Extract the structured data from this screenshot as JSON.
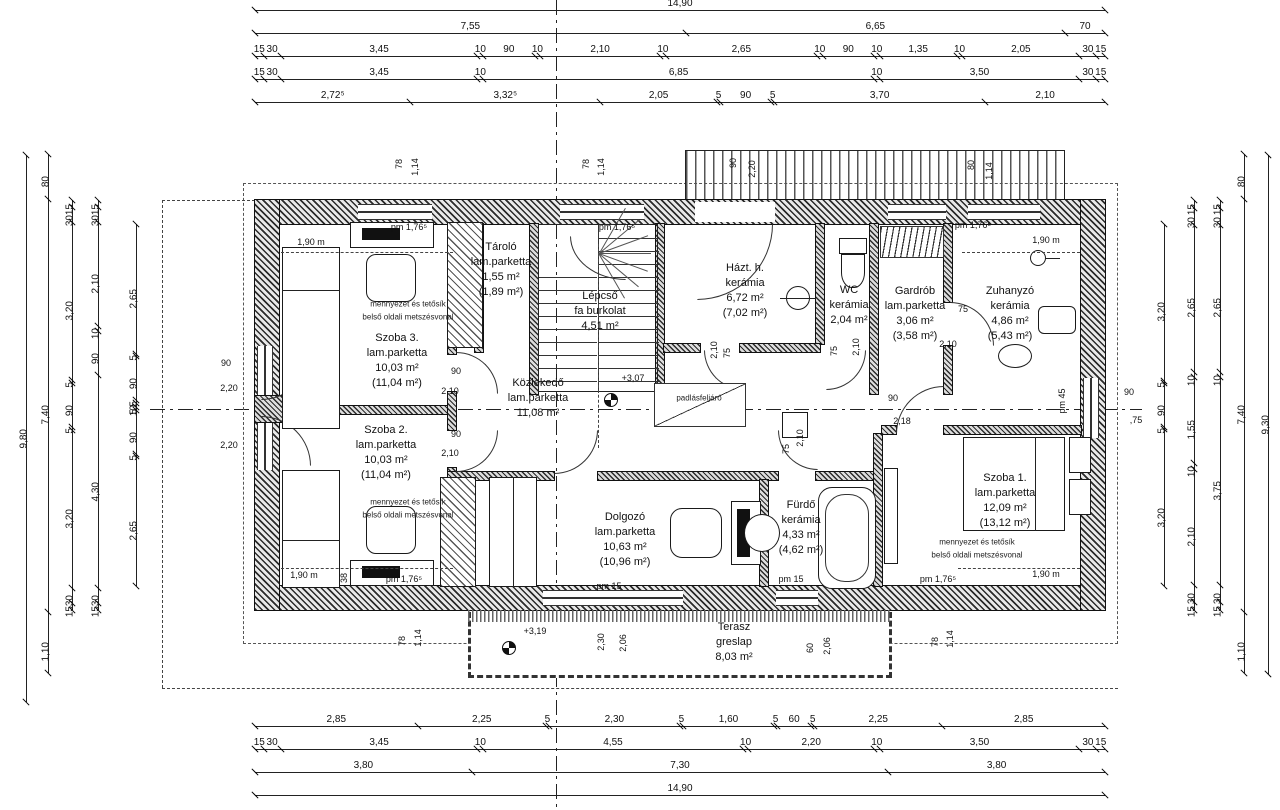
{
  "rooms": [
    {
      "name": "Szoba 3.",
      "material": "lam.parketta",
      "area": "10,03 m²",
      "area_total": "(11,04 m²)"
    },
    {
      "name": "Tároló",
      "material": "lam.parketta",
      "area": "1,55 m²",
      "area_total": "(1,89 m²)"
    },
    {
      "name": "Lépcső",
      "material": "fa burkolat",
      "area": "4,51 m²",
      "area_total": ""
    },
    {
      "name": "Házt. h.",
      "material": "kerámia",
      "area": "6,72 m²",
      "area_total": "(7,02 m²)"
    },
    {
      "name": "WC",
      "material": "kerámia",
      "area": "2,04 m²",
      "area_total": ""
    },
    {
      "name": "Gardrób",
      "material": "lam.parketta",
      "area": "3,06 m²",
      "area_total": "(3,58 m²)"
    },
    {
      "name": "Zuhanyzó",
      "material": "kerámia",
      "area": "4,86 m²",
      "area_total": "(5,43 m²)"
    },
    {
      "name": "Szoba 2.",
      "material": "lam.parketta",
      "area": "10,03 m²",
      "area_total": "(11,04 m²)"
    },
    {
      "name": "Közlekedő",
      "material": "lam.parketta",
      "area": "11,08 m²",
      "area_total": ""
    },
    {
      "name": "Dolgozó",
      "material": "lam.parketta",
      "area": "10,63 m²",
      "area_total": "(10,96 m²)"
    },
    {
      "name": "Fürdő",
      "material": "kerámia",
      "area": "4,33 m²",
      "area_total": "(4,62 m²)"
    },
    {
      "name": "Szoba 1.",
      "material": "lam.parketta",
      "area": "12,09 m²",
      "area_total": "(13,12 m²)"
    },
    {
      "name": "Terasz",
      "material": "greslap",
      "area": "8,03 m²",
      "area_total": ""
    }
  ],
  "levels": {
    "upper_floor": "+3,07",
    "terrace": "+3,19"
  },
  "notes": {
    "section_line_1": "mennyezet és tetősík",
    "section_line_2": "belső oldali metszésvonal",
    "attic_access": "padlásfeljáró"
  },
  "pm": {
    "pm176": "pm 1,76⁵",
    "pm15": "pm 15",
    "pm45": "pm 45"
  },
  "openings": {
    "w90": "90",
    "h210": "2,10",
    "w75": "75",
    "h218": "2,18",
    "h220": "2,20",
    "w230": "2,30",
    "w206": "2,06",
    "w60": "60",
    "w78": "78",
    "w114": "1,14",
    "w80": "80",
    "p75": ",75",
    "w38": "38",
    "bed": "1,90 m"
  },
  "dims": {
    "top": {
      "row1": [
        "14,90"
      ],
      "row2": [
        "7,55",
        "6,65",
        "70"
      ],
      "row3": [
        "15",
        "30",
        "3,45",
        "10",
        "90",
        "10",
        "2,10",
        "10",
        "2,65",
        "10",
        "90",
        "10",
        "1,35",
        "10",
        "2,05",
        "30",
        "15"
      ],
      "row4": [
        "15",
        "30",
        "3,45",
        "10",
        "6,85",
        "10",
        "3,50",
        "30",
        "15"
      ],
      "row5": [
        "2,72⁵",
        "3,32⁵",
        "2,05",
        "5",
        "90",
        "5",
        "3,70",
        "2,10"
      ]
    },
    "bottom": {
      "row1": [
        "2,85",
        "2,25",
        "5",
        "2,30",
        "5",
        "1,60",
        "5",
        "60",
        "5",
        "2,25",
        "2,85"
      ],
      "row2": [
        "15",
        "30",
        "3,45",
        "10",
        "4,55",
        "10",
        "2,20",
        "10",
        "3,50",
        "30",
        "15"
      ],
      "row3": [
        "3,80",
        "7,30",
        "3,80"
      ],
      "row4": [
        "14,90"
      ]
    },
    "left": {
      "c1": [
        "9,80"
      ],
      "c2": [
        "80",
        "7,40",
        "1,10"
      ],
      "c3": [
        "15",
        "30",
        "3,20",
        "5",
        "90",
        "5",
        "3,20",
        "30",
        "15"
      ],
      "c4": [
        "15",
        "30",
        "2,10",
        "10",
        "90",
        "4,30",
        "30",
        "15"
      ],
      "c5": [
        "2,65",
        "5",
        "90",
        "5",
        "10",
        "5",
        "90",
        "5",
        "2,65"
      ]
    },
    "right": {
      "c1": [
        "9,30"
      ],
      "c2": [
        "80",
        "7,40",
        "1,10"
      ],
      "c3": [
        "15",
        "30",
        "2,65",
        "10",
        "3,75",
        "30",
        "15"
      ],
      "c4": [
        "15",
        "30",
        "2,65",
        "10",
        "1,55",
        "10",
        "2,10",
        "30",
        "15"
      ],
      "c5": [
        "3,20",
        "5",
        "90",
        "5",
        "3,20"
      ]
    }
  }
}
